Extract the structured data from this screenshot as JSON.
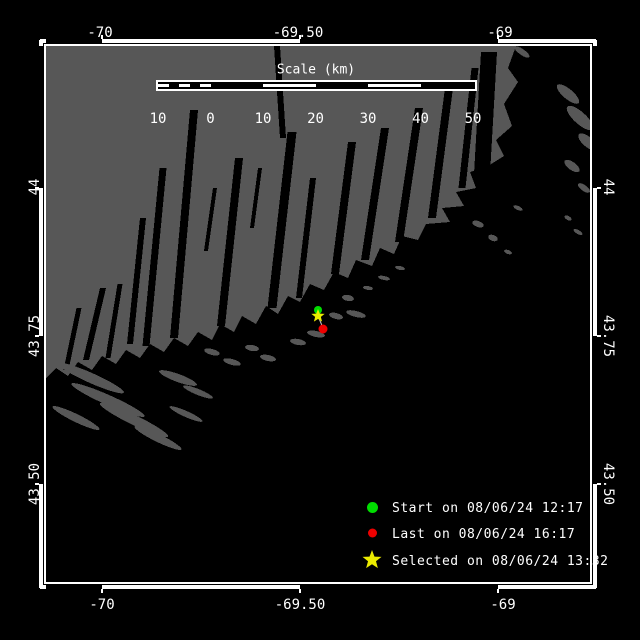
{
  "colors": {
    "background": "#000000",
    "water": "#000000",
    "land": "#575757",
    "frame": "#ffffff",
    "text": "#ffffff",
    "start_marker": "#00dd00",
    "last_marker": "#ee0000",
    "selected_marker": "#ebeb00",
    "track_line": "#c8c8c8"
  },
  "axes": {
    "top": [
      "-70",
      "-69.50",
      "-69"
    ],
    "bottom": [
      "-70",
      "-69.50",
      "-69"
    ],
    "left": [
      "44",
      "43.75",
      "43.50"
    ],
    "right": [
      "44",
      "43.75",
      "43.50"
    ]
  },
  "scale_bar": {
    "title": "Scale (km)",
    "labels": [
      "10",
      "0",
      "10",
      "20",
      "30",
      "40",
      "50"
    ]
  },
  "legend": [
    {
      "symbol": "circle",
      "color": "#00dd00",
      "label": "Start on 08/06/24 12:17"
    },
    {
      "symbol": "circle",
      "color": "#ee0000",
      "label": "Last on 08/06/24 16:17"
    },
    {
      "symbol": "star",
      "color": "#ebeb00",
      "label": "Selected on 08/06/24 13:32"
    }
  ]
}
